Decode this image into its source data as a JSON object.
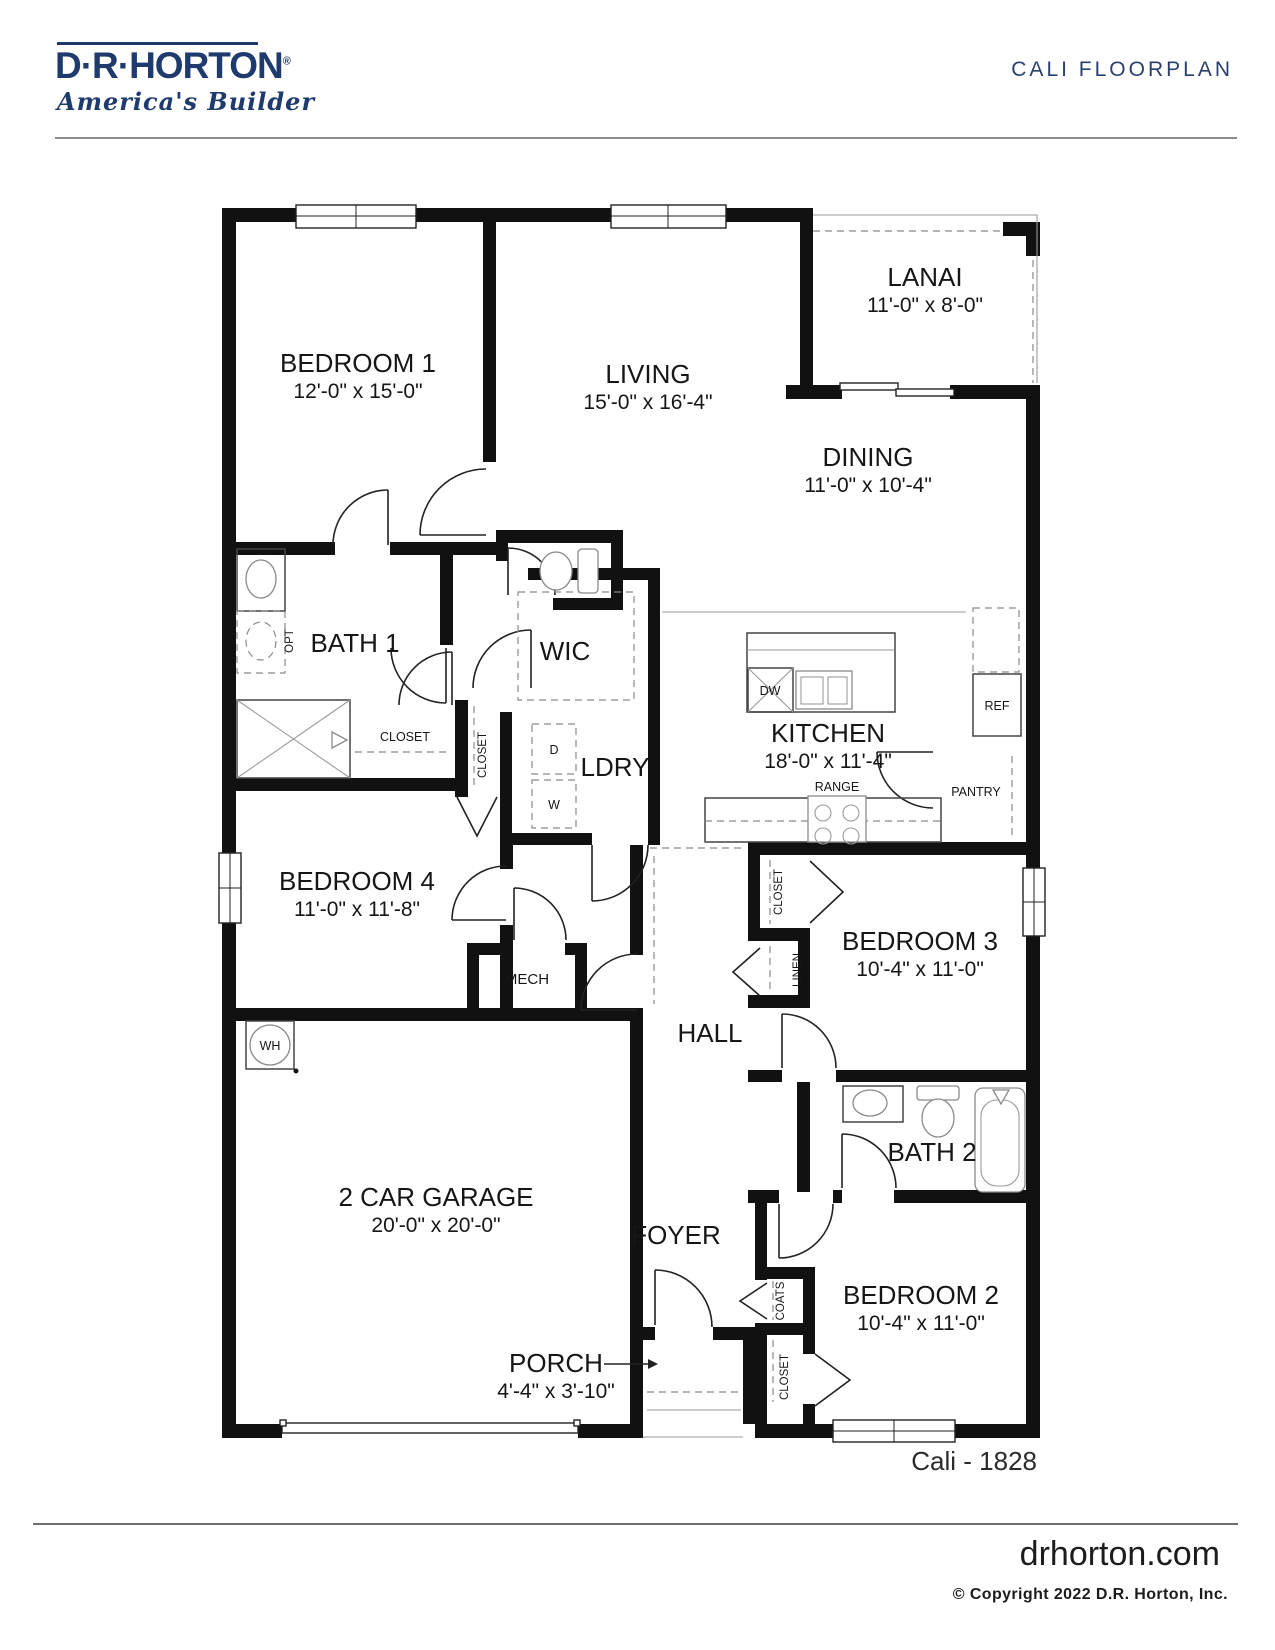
{
  "header": {
    "logo": {
      "brand": "D·R·HORTON",
      "reg": "®",
      "tagline": "America's Builder"
    },
    "title": "CALI FLOORPLAN"
  },
  "rooms": {
    "bedroom1": {
      "name": "BEDROOM 1",
      "dims": "12'-0\" x 15'-0\""
    },
    "living": {
      "name": "LIVING",
      "dims": "15'-0\" x 16'-4\""
    },
    "lanai": {
      "name": "LANAI",
      "dims": "11'-0\" x 8'-0\""
    },
    "dining": {
      "name": "DINING",
      "dims": "11'-0\" x 10'-4\""
    },
    "kitchen": {
      "name": "KITCHEN",
      "dims": "18'-0\" x 11'-4\""
    },
    "bath1": {
      "name": "BATH 1"
    },
    "wic": {
      "name": "WIC"
    },
    "ldry": {
      "name": "LDRY"
    },
    "bedroom4": {
      "name": "BEDROOM 4",
      "dims": "11'-0\" x 11'-8\""
    },
    "bedroom3": {
      "name": "BEDROOM 3",
      "dims": "10'-4\" x 11'-0\""
    },
    "mech": {
      "name": "MECH"
    },
    "hall": {
      "name": "HALL"
    },
    "bath2": {
      "name": "BATH 2"
    },
    "garage": {
      "name": "2 CAR GARAGE",
      "dims": "20'-0\" x 20'-0\""
    },
    "foyer": {
      "name": "FOYER"
    },
    "bedroom2": {
      "name": "BEDROOM 2",
      "dims": "10'-4\" x 11'-0\""
    },
    "porch": {
      "name": "PORCH",
      "dims": "4'-4\" x 3'-10\""
    }
  },
  "fixtures": {
    "dw": "DW",
    "ref": "REF",
    "range": "RANGE",
    "pantry": "PANTRY",
    "dryer": "D",
    "washer": "W",
    "wh": "WH",
    "opt": "OPT"
  },
  "closets": {
    "bath1_closet": "CLOSET",
    "hall_closet": "CLOSET",
    "bed3_closet": "CLOSET",
    "linen": "LINEN",
    "coats": "COATS",
    "bed2_closet": "CLOSET"
  },
  "plan_code": "Cali - 1828",
  "footer": {
    "site": "drhorton.com",
    "copyright": "© Copyright 2022 D.R. Horton, Inc."
  },
  "colors": {
    "brand_navy": "#1f3a6d",
    "wall_black": "#111111",
    "rule_gray": "#8c8c8c"
  }
}
